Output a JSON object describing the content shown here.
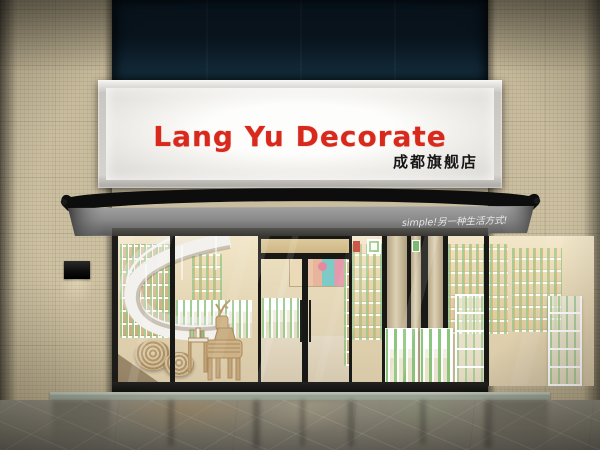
{
  "sign": {
    "title": "Lang Yu Decorate",
    "subtitle": "成都旗舰店"
  },
  "awning": {
    "slogan": "simple!另一种生活方式!"
  },
  "colors": {
    "sign_red": "#d8291d",
    "glow": "#fdfdfb",
    "navy_top": "#0c1d2a",
    "navy_bottom": "#16303f",
    "tile": "#c9bda0",
    "awning_top": "#0d0d0d",
    "valance_light": "#9c9c9c",
    "valance_dark": "#5a5a5a",
    "interior_light": "#f2e6c8",
    "interior_mid": "#e0d0ac",
    "product_green": "#94c788",
    "floor_light": "#8e8a7c",
    "floor_dark": "#66635a",
    "threshold": "#9aa294"
  }
}
